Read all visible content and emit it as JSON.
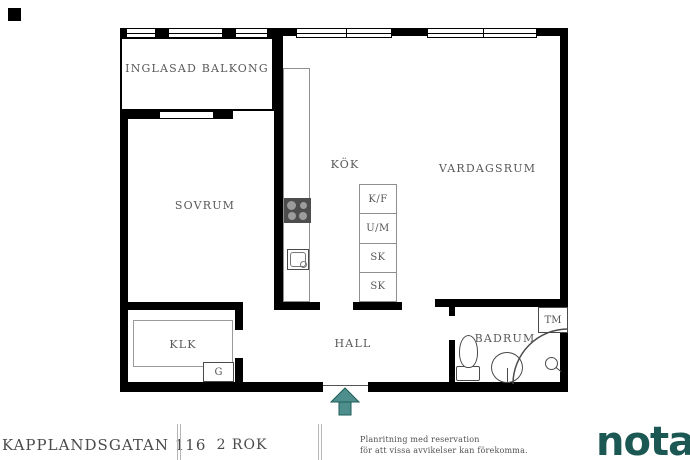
{
  "plan": {
    "rooms": [
      {
        "id": "inglasad-balkong",
        "label": "INGLASAD BALKONG"
      },
      {
        "id": "sovrum",
        "label": "SOVRUM"
      },
      {
        "id": "kok",
        "label": "KÖK"
      },
      {
        "id": "vardagsrum",
        "label": "VARDAGSRUM"
      },
      {
        "id": "klk",
        "label": "KLK"
      },
      {
        "id": "hall",
        "label": "HALL"
      },
      {
        "id": "badrum",
        "label": "BADRUM"
      }
    ],
    "fixtures": {
      "cabinets": [
        {
          "label": "K/F"
        },
        {
          "label": "U/M"
        },
        {
          "label": "SK"
        },
        {
          "label": "SK"
        }
      ],
      "wardrobe_label": "G",
      "washing_machine_label": "TM"
    }
  },
  "footer": {
    "address": "KAPPLANDSGATAN 116",
    "rooms_count": "2 ROK",
    "disclaimer": [
      "Planritning med reservation",
      "för att vissa avvikelser kan förekomma."
    ],
    "brand": "notar"
  },
  "colors": {
    "wall": "#000000",
    "label_text": "#595959",
    "fixture_line": "#4a4a4a",
    "cabinet_line": "#8f8f8f",
    "brand_teal": "#1b5854",
    "arrow_fill": "#4e8f8e",
    "arrow_stroke": "#1d5c58",
    "stove": "#4d4d4d",
    "burner": "#9c9c9c"
  }
}
